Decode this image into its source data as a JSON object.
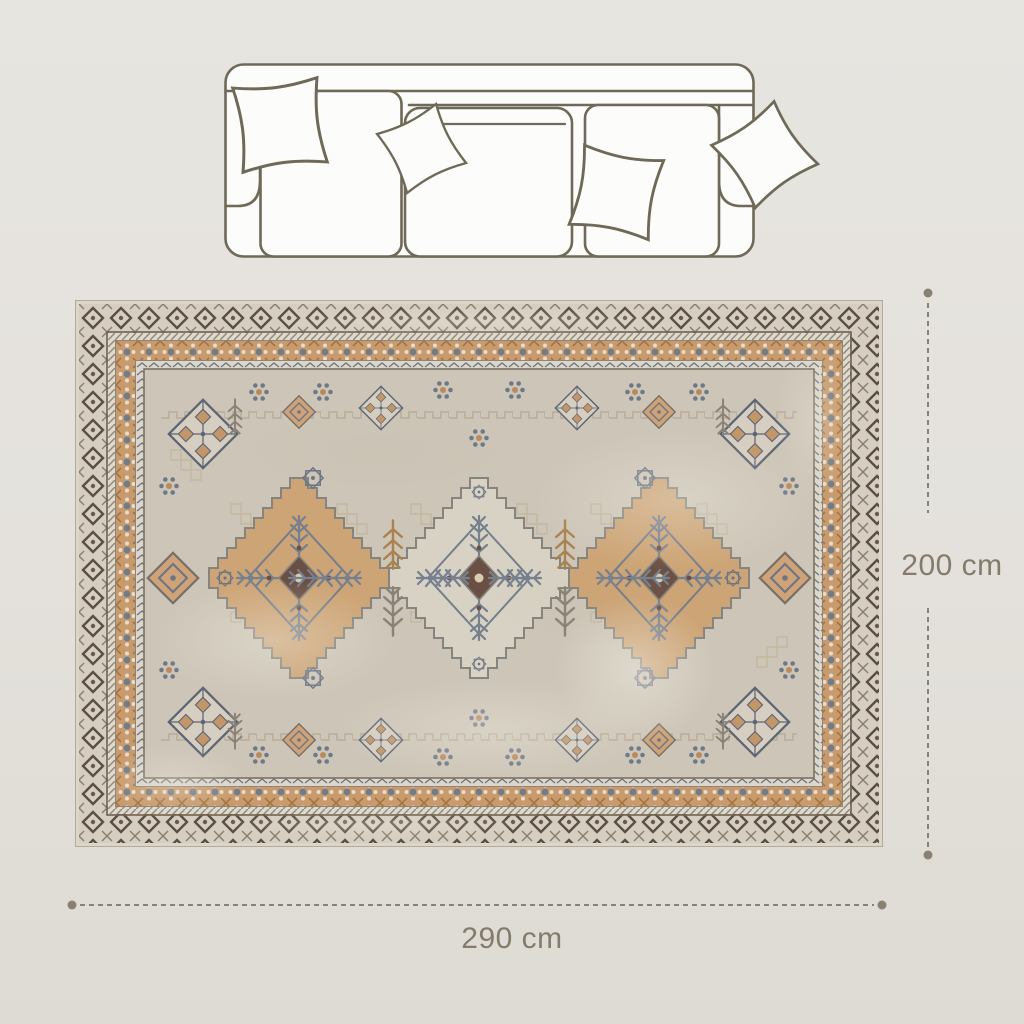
{
  "diagram": {
    "type": "product-dimension-diagram",
    "sofa_icon": "sofa-top-view-icon",
    "sofa_seats_visible": 3,
    "sofa_pillows_visible": 4,
    "rug_image": "vintage-oriental-area-rug",
    "rug_medallions_visible": 3
  },
  "dimensions": {
    "height": {
      "label": "200 cm"
    },
    "width": {
      "label": "290 cm"
    }
  },
  "colors": {
    "page_background": "#e4e1dc",
    "dimension_line": "#8b8173",
    "dimension_text": "#857b6b",
    "sofa_outline": "#6f6958",
    "sofa_fill": "#fcfcfb",
    "rug_field": "#cdc6b8",
    "rug_border_cream": "#d6cfc1",
    "rug_motif_dark_brown": "#5a4f44",
    "rug_motif_tan": "#c89b6e",
    "rug_motif_blue_gray": "#6b7585",
    "rug_medallion_tan": "#cda475",
    "rug_medallion_cream": "#d8d2c4"
  }
}
